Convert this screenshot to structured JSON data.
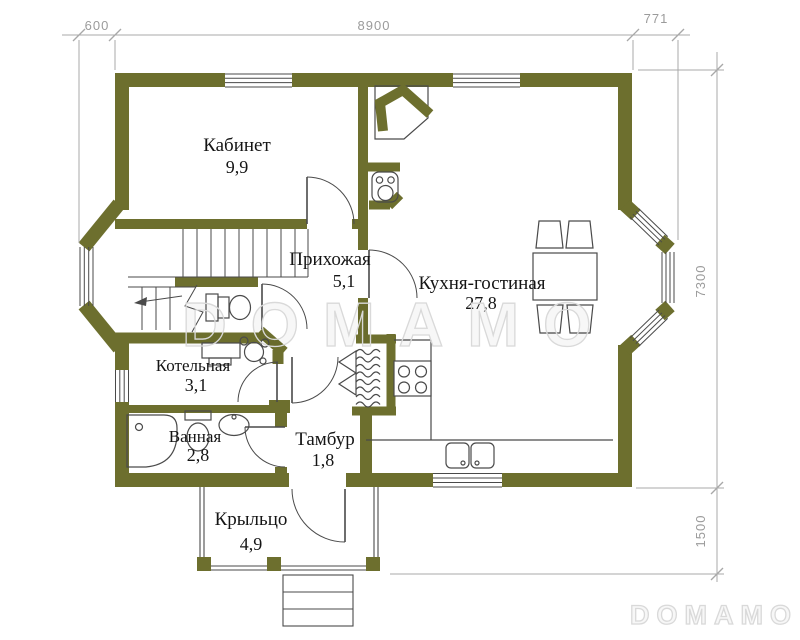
{
  "rooms": {
    "kabinet": {
      "name": "Кабинет",
      "area": "9,9"
    },
    "prihozhaya": {
      "name": "Прихожая",
      "area": "5,1"
    },
    "kitchen": {
      "name": "Кухня-гостиная",
      "area": "27,8"
    },
    "kotelnaya": {
      "name": "Котельная",
      "area": "3,1"
    },
    "vannaya": {
      "name": "Ванная",
      "area": "2,8"
    },
    "tambur": {
      "name": "Тамбур",
      "area": "1,8"
    },
    "krylco": {
      "name": "Крыльцо",
      "area": "4,9"
    }
  },
  "dimensions": {
    "top_left": "600",
    "top_center": "8900",
    "top_right": "771",
    "right_upper": "7300",
    "right_lower": "1500"
  },
  "watermark": {
    "center": "DOMAMO",
    "corner": "DOMAMO"
  },
  "colors": {
    "wall": "#6d6f2e",
    "line": "#4a4a4a",
    "dimension": "#a8a8a8",
    "dimension_text": "#9b9b9b",
    "label_text": "#151515",
    "watermark": "#d9d9d9"
  }
}
